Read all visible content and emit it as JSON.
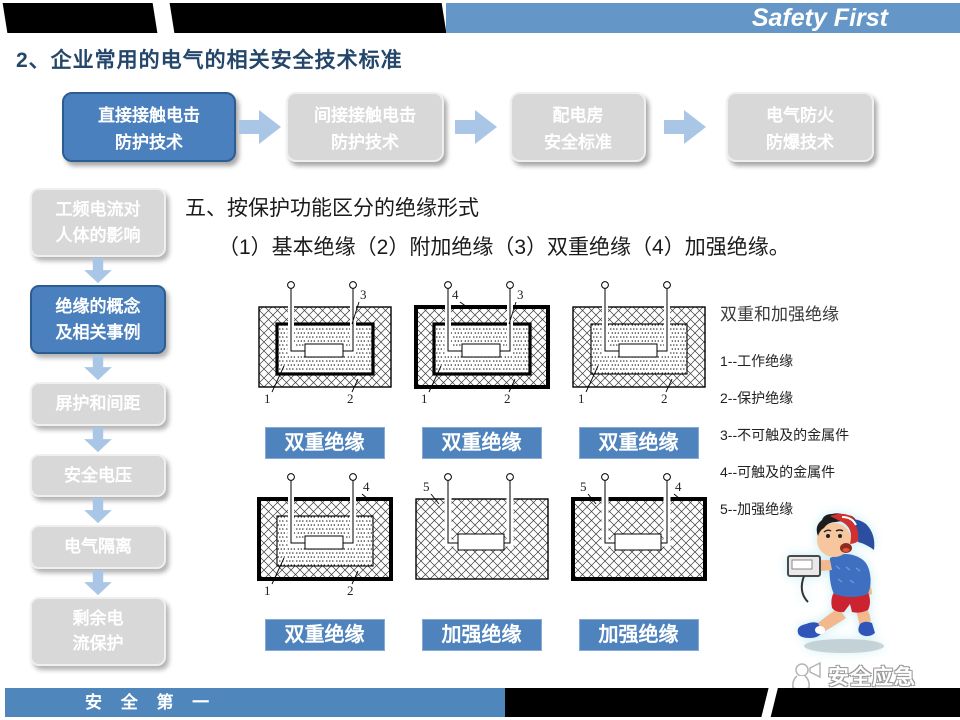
{
  "header": {
    "brand": "Safety First",
    "page_title": "2、企业常用的电气的相关安全技术标准"
  },
  "flow_steps": [
    {
      "line1": "直接接触电击",
      "line2": "防护技术",
      "active": true
    },
    {
      "line1": "间接接触电击",
      "line2": "防护技术",
      "active": false
    },
    {
      "line1": "配电房",
      "line2": "安全标准",
      "active": false
    },
    {
      "line1": "电气防火",
      "line2": "防爆技术",
      "active": false
    }
  ],
  "sidebar_items": [
    {
      "line1": "工频电流对",
      "line2": "人体的影响",
      "active": false
    },
    {
      "line1": "绝缘的概念",
      "line2": "及相关事例",
      "active": true
    },
    {
      "line1": "屏护和间距",
      "line2": "",
      "active": false
    },
    {
      "line1": "安全电压",
      "line2": "",
      "active": false
    },
    {
      "line1": "电气隔离",
      "line2": "",
      "active": false
    },
    {
      "line1": "剩余电",
      "line2": "流保护",
      "active": false
    }
  ],
  "content": {
    "heading": "五、按保护功能区分的绝缘形式",
    "subheading": "（1）基本绝缘（2）附加绝缘（3）双重绝缘（4）加强绝缘。"
  },
  "diagrams": [
    {
      "caption": "双重绝缘",
      "outer_border": "thin",
      "inner_box": "thick",
      "top_right": "3",
      "bottom_left": "1",
      "bottom_right": "2"
    },
    {
      "caption": "双重绝缘",
      "outer_border": "thick",
      "inner_box": "thick",
      "top_left": "4",
      "top_right": "3",
      "bottom_left": "1",
      "bottom_right": "2"
    },
    {
      "caption": "双重绝缘",
      "outer_border": "thin",
      "inner_box": "thin",
      "bottom_left": "1",
      "bottom_right": "2"
    },
    {
      "caption": "双重绝缘",
      "outer_border": "thick",
      "inner_box": "thin",
      "top_right": "4",
      "bottom_left": "1",
      "bottom_right": "2"
    },
    {
      "caption": "加强绝缘",
      "outer_border": "thin",
      "inner_box": "none",
      "top_left": "5"
    },
    {
      "caption": "加强绝缘",
      "outer_border": "thick",
      "inner_box": "none",
      "top_left": "5",
      "top_right": "4"
    }
  ],
  "legend": {
    "title": "双重和加强绝缘",
    "items": [
      "1--工作绝缘",
      "2--保护绝缘",
      "3--不可触及的金属件",
      "4--可触及的金属件",
      "5--加强绝缘"
    ]
  },
  "footer": {
    "slogan": "安 全 第 一",
    "watermark": "安全应急"
  },
  "colors": {
    "accent_blue": "#4a80bd",
    "header_blue": "#6496c8",
    "caption_blue": "#4f83be",
    "arrow_blue": "#a9c6e6",
    "idle_gray": "#d8d8d8"
  }
}
